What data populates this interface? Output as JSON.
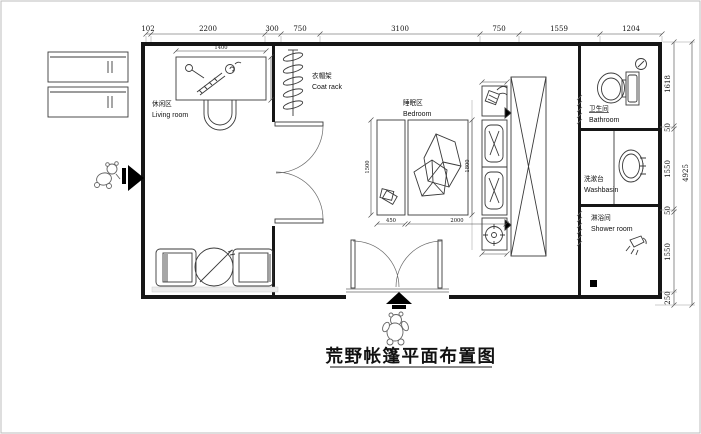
{
  "title": "荒野帐篷平面布置图",
  "dims": {
    "top": [
      "102",
      "2200",
      "300",
      "750",
      "3100",
      "750",
      "1559",
      "1204"
    ],
    "right": [
      "1618",
      "50",
      "1550",
      "50",
      "1550",
      "250"
    ],
    "right_total": "4925",
    "furniture": {
      "desk_width": "1400",
      "bench_depth": "1500",
      "bench_width": "450",
      "bed_length": "2000",
      "bed_width": "1800"
    }
  },
  "rooms": {
    "living": {
      "zh": "休闲区",
      "en": "Living room"
    },
    "coat_rack": {
      "zh": "衣帽架",
      "en": "Coat rack"
    },
    "bedroom": {
      "zh": "睡眠区",
      "en": "Bedroom"
    },
    "bathroom": {
      "zh": "卫生间",
      "en": "Bathroom"
    },
    "washbasin": {
      "zh": "洗漱台",
      "en": "Washbasin"
    },
    "shower": {
      "zh": "淋浴间",
      "en": "Shower room"
    }
  }
}
